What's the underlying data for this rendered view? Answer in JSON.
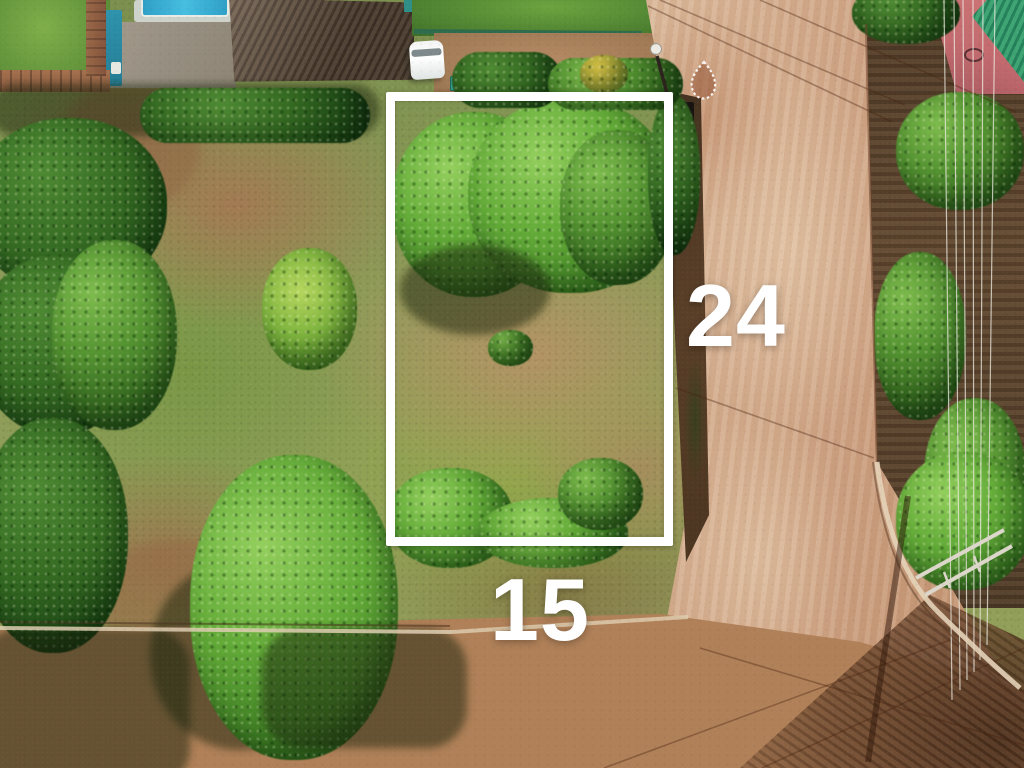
{
  "scene": {
    "type": "aerial-drone-photo",
    "subject": "vacant corner land plot marked with white boundary overlay",
    "labels": {
      "side_depth": "24",
      "side_width": "15"
    },
    "outline_color": "#ffffff",
    "label_color": "#ffffff",
    "palette": {
      "road_light_tan": "#d8b495",
      "cross_road_brown": "#a5734f",
      "soil_dark_brown": "#5f462e",
      "lot_grass_green": "#8fa84e",
      "lot_dirt_tan": "#b29068",
      "tree_green_bright": "#63ab38",
      "tree_green_dark": "#2f5c20",
      "pool_blue": "#46bee0",
      "tarp_teal": "#2e93ac",
      "dark_roof_brown": "#5a4838",
      "green_roof": "#3fa474",
      "pink_wall": "#c26a6e"
    }
  }
}
